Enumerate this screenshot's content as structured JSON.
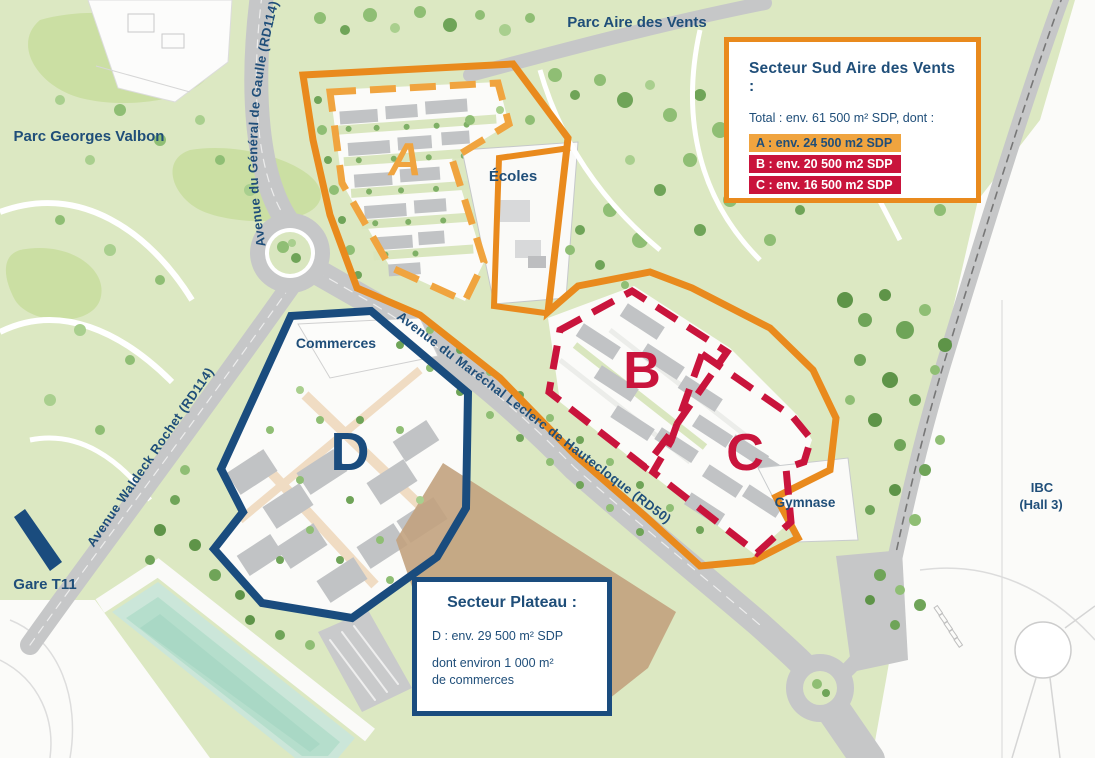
{
  "colors": {
    "orange_boundary": "#E98A1D",
    "amber_sector_a": "#F0A43F",
    "crimson_sectors_bc": "#C9143C",
    "navy_sector_d": "#1A4C7E",
    "navy_text": "#1F4E79",
    "park_green": "#DCE8C2",
    "road_gray": "#C6C7C8",
    "water_mint": "#BFE2D4",
    "building_gray": "#C1C3C5",
    "field_tan": "#C2A27E"
  },
  "map_labels": {
    "parc_aire": "Parc Aire des Vents",
    "parc_valbon": "Parc Georges Valbon",
    "ecoles": "Écoles",
    "commerces": "Commerces",
    "gymnase": "Gymnase",
    "gare": "Gare T11",
    "ibc_line1": "IBC",
    "ibc_line2": "(Hall 3)",
    "road_gaulle": "Avenue du Général de Gaulle (RD114)",
    "road_waldeck": "Avenue Waldeck Rochet (RD114)",
    "road_leclerc": "Avenue du Maréchal Leclerc de Hautecloque (RD50)"
  },
  "sector_letters": {
    "a": "A",
    "b": "B",
    "c": "C",
    "d": "D"
  },
  "legend_sud": {
    "title": "Secteur Sud Aire des Vents :",
    "total": "Total : env. 61 500 m² SDP, dont :",
    "row_a": "A : env. 24 500 m2 SDP",
    "row_b": "B : env. 20 500 m2 SDP",
    "row_c": "C : env. 16 500 m2 SDP"
  },
  "legend_plateau": {
    "title": "Secteur Plateau :",
    "line1": "D : env. 29 500 m² SDP",
    "line2": "dont environ 1 000 m²",
    "line3": "de commerces"
  }
}
